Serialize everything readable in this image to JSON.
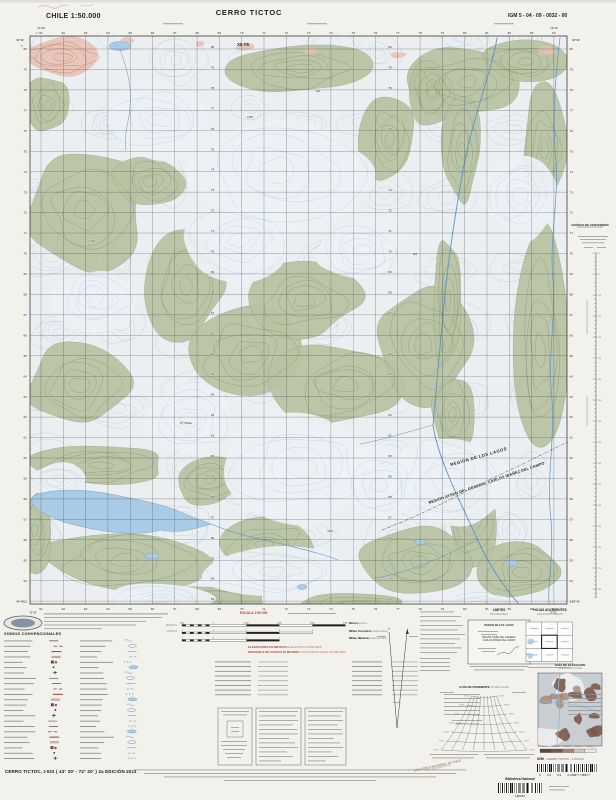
{
  "header": {
    "country_scale": "CHILE  1:50.000",
    "title": "CERRO TICTOC",
    "sheet_code": "IGM 5 - 04 - 09 - 0032 - 00"
  },
  "map": {
    "corners": {
      "lon_left": "72°30'",
      "lon_right": "72°20'",
      "lat_top": "43°30'",
      "lat_bottom": "43°40'",
      "zone_e": "72",
      "zone_n": "51"
    },
    "grid": {
      "eastings": [
        "61",
        "62",
        "63",
        "64",
        "65",
        "66",
        "67",
        "68",
        "69",
        "70",
        "71",
        "72",
        "73",
        "74",
        "75",
        "76",
        "77",
        "78",
        "79",
        "80",
        "81",
        "82",
        "83",
        "84"
      ],
      "northings": [
        "80",
        "79",
        "78",
        "77",
        "76",
        "75",
        "74",
        "73",
        "72",
        "71",
        "70",
        "69",
        "68",
        "67",
        "66",
        "65",
        "64",
        "63",
        "62",
        "61",
        "60",
        "59",
        "58",
        "57",
        "56",
        "55",
        "54",
        "53"
      ]
    },
    "note": "X5 Y5",
    "region1": "REGION DE   LOS LAGOS",
    "region2": "REGION AYSEN DEL GENERAL CARLOS IBAÑEZ DEL CAMPO",
    "peak": "Cº Tictoc",
    "spot_heights": [
      "1255",
      "1340",
      "844",
      "986",
      "1125"
    ]
  },
  "scalebar": {
    "escala": "ESCALA 1:50.000",
    "units_left": [
      "METROS",
      "YARDAS"
    ],
    "bars": [
      {
        "es": "Metros",
        "en": "Meters",
        "ticks": [
          "1000",
          "0",
          "1000",
          "2000",
          "3000",
          "4000"
        ]
      },
      {
        "es": "Millas Terrestres",
        "en": "Statute Miles",
        "ticks": [
          "1",
          "0",
          "1",
          "2",
          "3"
        ]
      },
      {
        "es": "Millas Náuticas",
        "en": "Nautical Miles",
        "ticks": [
          "1",
          "0",
          "1",
          "2"
        ]
      }
    ],
    "elev1_es": "ELEVACIONES EN METROS",
    "elev1_en": "ELEVATIONS IN METERS",
    "elev2_es": "INTERVALO DE CURVAS 50 METROS",
    "elev2_en": "CONTOUR INTERVAL 50 METERS"
  },
  "legend": {
    "signos": "SIGNOS CONVENCIONALES"
  },
  "limites": {
    "title_es": "LIMITES",
    "title_en": "BOUNDARIES",
    "region_top": "REGIÓN DE LOS LAGOS",
    "region_b1": "REGIÓN AYSÉN DEL GENERAL",
    "region_b2": "CARLOS IBÁÑEZ DEL CAMPO"
  },
  "hojas": {
    "title_es": "HOJAS ADYACENTES",
    "title_en": "ADJOINING SHEETS"
  },
  "guia_elev": {
    "title_es": "GUÍA DE ELEVACIÓN",
    "title_en": "ELEVATION GUIDE"
  },
  "guia_pend": {
    "title_es": "GUÍA DE PENDIENTE",
    "title_en": "SLOPE GUIDE"
  },
  "conversion": {
    "title_es": "GRÁFICO DE CONVERSIÓN",
    "title_en": "CONVERSION GRAPH",
    "ticks": [
      "0",
      "5",
      "10",
      "15",
      "20",
      "25",
      "30",
      "35",
      "40",
      "45",
      "50",
      "55",
      "60",
      "65",
      "70",
      "75",
      "80"
    ]
  },
  "publisher": {
    "igm": "IGM",
    "rest": "-  CERRO TICTOC  -  1:50.000",
    "digits": "5    04    09    0032    00"
  },
  "biblioteca": {
    "stamp1": "BIBLIOTECA NACIONAL DE CHILE",
    "stamp2": "SECCIÓN MAPOTECA",
    "label": "Biblioteca Nacional",
    "number": "192183"
  },
  "footer": {
    "title": "CERRO TICTOC,  I-032 ( 43° 30' - 72° 20' )  2a EDICIÓN 2011"
  },
  "colors": {
    "veg": "#b7c3a2",
    "veg_contour": "#87936e",
    "snow_contour": "#a7c3da",
    "lake": "#a9cbe6",
    "lake_edge": "#79a6c8",
    "river": "#5f93c4",
    "scree": "#e6c0b2",
    "scree_contour": "#c4725c",
    "grid": "#4a4a4a",
    "red_text": "#b5402c",
    "paper": "#f3f1ec",
    "map_base": "#ecefF1"
  }
}
